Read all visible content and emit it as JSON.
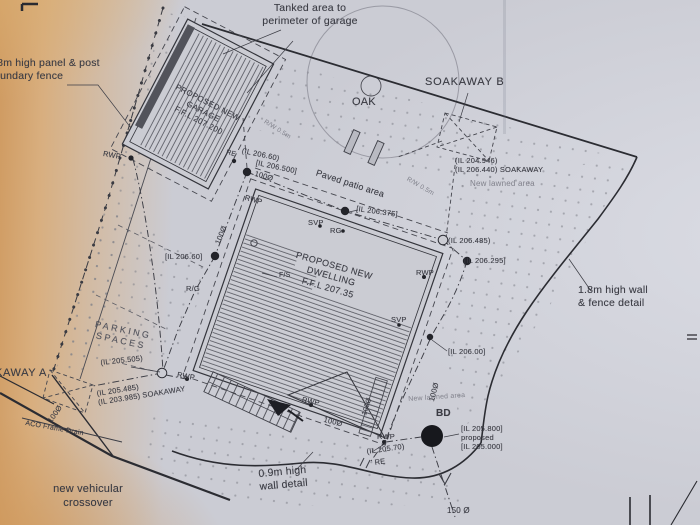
{
  "palette": {
    "paper_cool": "#cbccd4",
    "paper_warm": "#d8ae7e",
    "ink": "#33343b",
    "ink_faint": "#80818b"
  },
  "symbols": {
    "manhole_filled": "●",
    "inspection_chamber_open": "○",
    "bd_bottom_drain": "●",
    "soakaway_box": "⊠"
  },
  "labels": {
    "tanked_area": "Tanked area to\nperimeter of garage",
    "panel_fence": "1.8m high panel & post\nboundary fence",
    "garage": "PROPOSED NEW\nGARAGE\nF.F.L 207.200",
    "dwelling": "PROPOSED NEW\nDWELLING\nF.F.L 207.35",
    "paved_patio": "Paved patio area",
    "parking": "PARKING\nSPACES",
    "oak": "OAK",
    "soakaway_b": "SOAKAWAY B",
    "soakaway_b_levels": "(IL 204.946)\n(IL 206.440) SOAKAWAY",
    "lawn_ne": "New lawned area",
    "lawn_s": "New lawned area",
    "wall_fence_detail": "1.8m high wall\n& fence detail",
    "wall_09_detail": "0.9m high\nwall detail",
    "soakaway_a": "SOAKAWAY A",
    "il_205_505": "(IL 205.505)",
    "soakaway_a_levels": "(IL 205.485)\n(IL 203.985) SOAKAWAY",
    "aco_drain": "ACO Frame Drain",
    "crossover": "new vehicular\ncrossover",
    "il_206_60_garage": "(IL 206.60)",
    "il_206_500": "[IL 206.500]",
    "il_206_375": "[IL 206.375]",
    "il_206_485": "(IL 206.485)",
    "il_206_295": "[IL 206.295]",
    "il_206_60_west": "[IL 206.60]",
    "il_206_00": "[IL 206.00]",
    "il_205_70": "(IL 205.70)",
    "bd": "BD",
    "bd_levels": "[IL 205.800]\nproposed\n[IL 205.000]",
    "dia_150": "150 Ø",
    "dia_100": "100Ø",
    "rwp": "RWP",
    "svp": "SVP",
    "rg": "RG",
    "rg_gully": "R/G",
    "fs": "F/S",
    "re": "RE",
    "rw_note": "R/W 0.5m"
  }
}
